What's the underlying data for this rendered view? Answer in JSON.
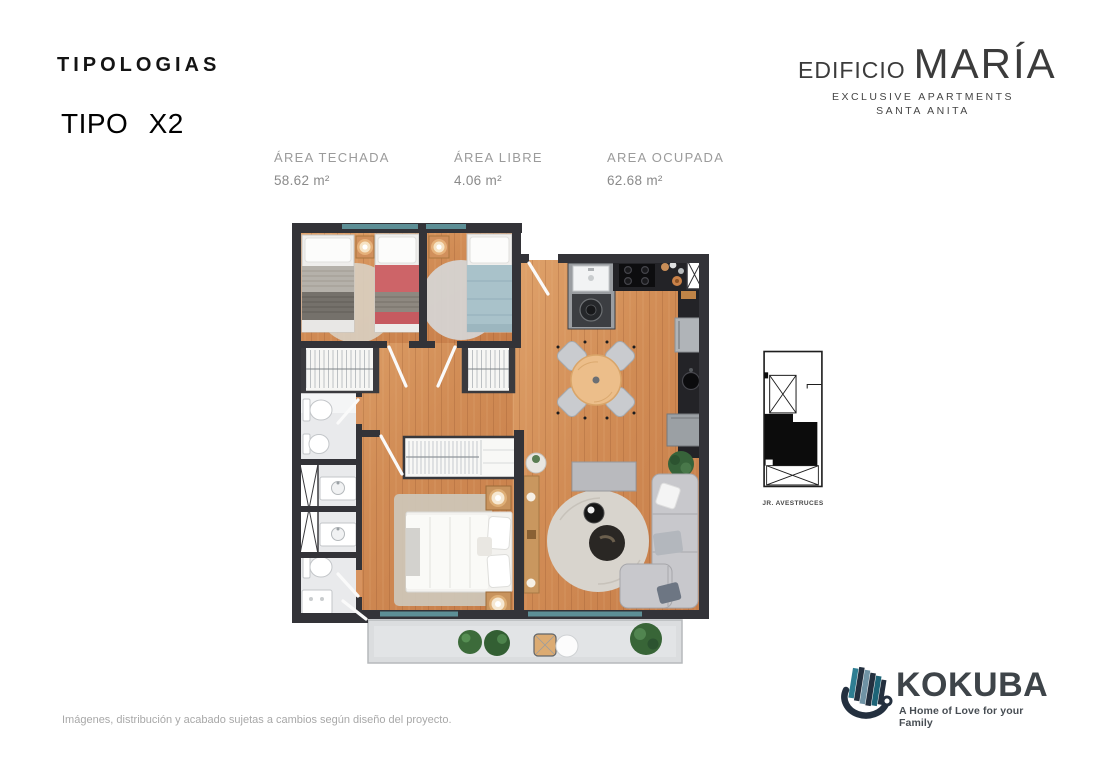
{
  "header": {
    "section_title": "TIPOLOGIAS",
    "unit_type": "TIPO X2"
  },
  "brand": {
    "prefix": "EDIFICIO",
    "name": "MARÍA",
    "subtitle_line1": "EXCLUSIVE APARTMENTS",
    "subtitle_line2": "SANTA ANITA"
  },
  "areas": [
    {
      "label": "ÁREA TECHADA",
      "value": "58.62 m²"
    },
    {
      "label": "ÁREA LIBRE",
      "value": "4.06 m²"
    },
    {
      "label": "AREA OCUPADA",
      "value": "62.68 m²"
    }
  ],
  "key_plan": {
    "street_label": "JR. AVESTRUCES"
  },
  "footer": {
    "disclaimer": "Imágenes, distribución y acabado sujetas a cambios según diseño del proyecto.",
    "logo_name": "KOKUBA",
    "logo_tagline": "A Home of Love for your Family"
  },
  "colors": {
    "wall": "#333338",
    "wood_floor": "#d18c55",
    "balcony_floor": "#dbdddf",
    "glass_window": "#5d8f96",
    "bed_red": "#cd6468",
    "bed_blue": "#a9c2ca",
    "plant_green": "#3c6b3a",
    "text_muted": "#9b9b9b",
    "logo_dark": "#3e4449",
    "logo_teal": "#2f7e92",
    "logo_navy": "#24303f"
  }
}
